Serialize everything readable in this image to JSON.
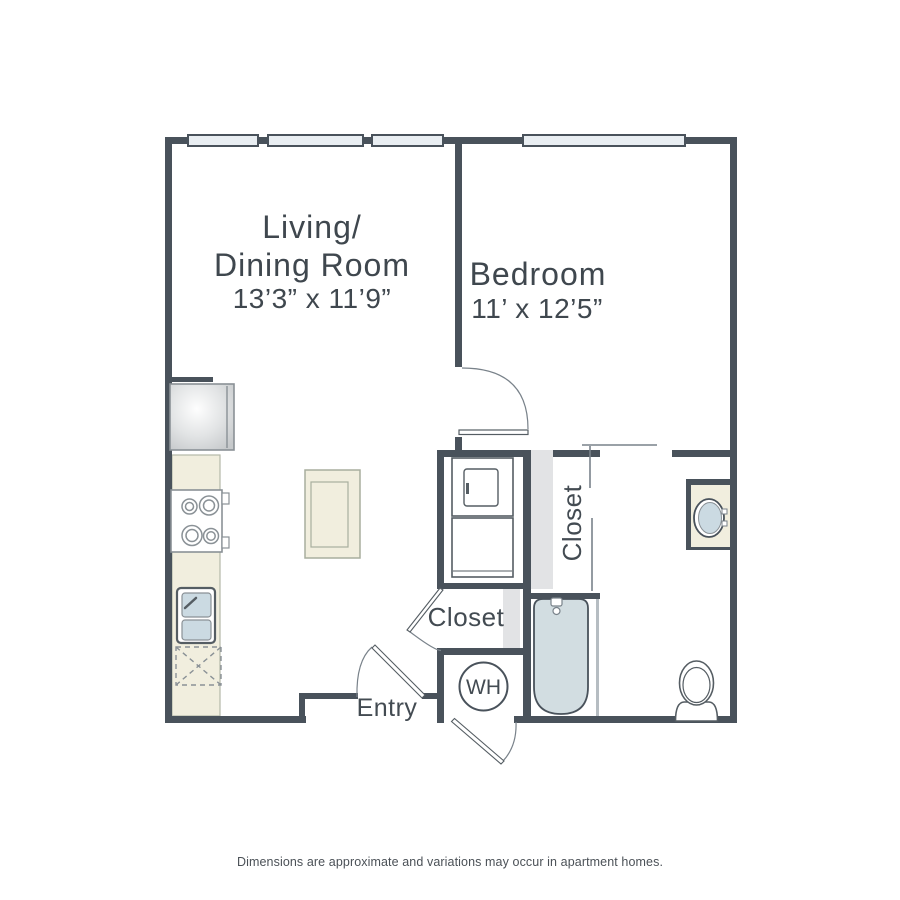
{
  "page": {
    "background": "#ffffff",
    "disclaimer": "Dimensions are approximate and variations may occur in apartment homes."
  },
  "colors": {
    "wall": "#49525b",
    "fixture_stroke_dark": "#555d63",
    "fixture_stroke_light": "#8a9196",
    "thin_line": "#79828a",
    "window_fill": "#e9eef2",
    "counter_beige": "#f1eede",
    "water_blue": "#cbdae2",
    "tub_blue": "#d2dde1",
    "closet_gray": "#e2e3e5",
    "label_text": "#3f474e"
  },
  "rooms": {
    "living_dining": {
      "name_line1": "Living/",
      "name_line2": "Dining Room",
      "dimensions": "13’3” x 11’9”"
    },
    "bedroom": {
      "name": "Bedroom",
      "dimensions": "11’ x 12’5”"
    },
    "bedroom_closet": {
      "label": "Closet"
    },
    "entry_closet": {
      "label": "Closet"
    },
    "entry": {
      "label": "Entry"
    },
    "water_heater": {
      "label": "WH"
    }
  }
}
